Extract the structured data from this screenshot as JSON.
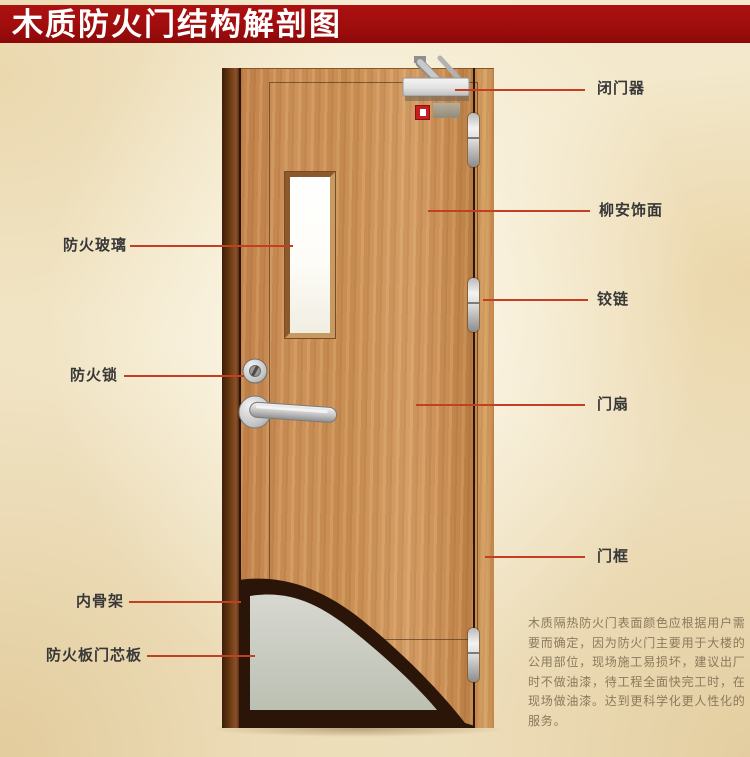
{
  "title": "木质防火门结构解剖图",
  "door_labels": {
    "left": [
      {
        "id": "fire-glass",
        "text": "防火玻璃"
      },
      {
        "id": "fire-lock",
        "text": "防火锁"
      },
      {
        "id": "inner-skeleton",
        "text": "内骨架"
      },
      {
        "id": "fire-board-core",
        "text": "防火板门芯板"
      }
    ],
    "right": [
      {
        "id": "door-closer",
        "text": "闭门器"
      },
      {
        "id": "lauan-veneer",
        "text": "柳安饰面"
      },
      {
        "id": "hinge",
        "text": "铰链"
      },
      {
        "id": "door-leaf",
        "text": "门扇"
      },
      {
        "id": "door-frame",
        "text": "门框"
      }
    ]
  },
  "description": "木质隔热防火门表面颜色应根据用户需要而确定，因为防火门主要用于大楼的公用部位，现场施工易损坏，建议出厂时不做油漆，待工程全面快完工时，在现场做油漆。达到更科学化更人性化的服务。",
  "colors": {
    "banner": "#a00d0d",
    "banner_text": "#ffffff",
    "callout_line": "#c23f24",
    "label_text": "#383838",
    "description_text": "#8a795c",
    "background": "#f3e8cb",
    "door_wood": "#c98e52",
    "core_panel": "#c9cbc1",
    "skeleton_dark": "#2b1408"
  }
}
